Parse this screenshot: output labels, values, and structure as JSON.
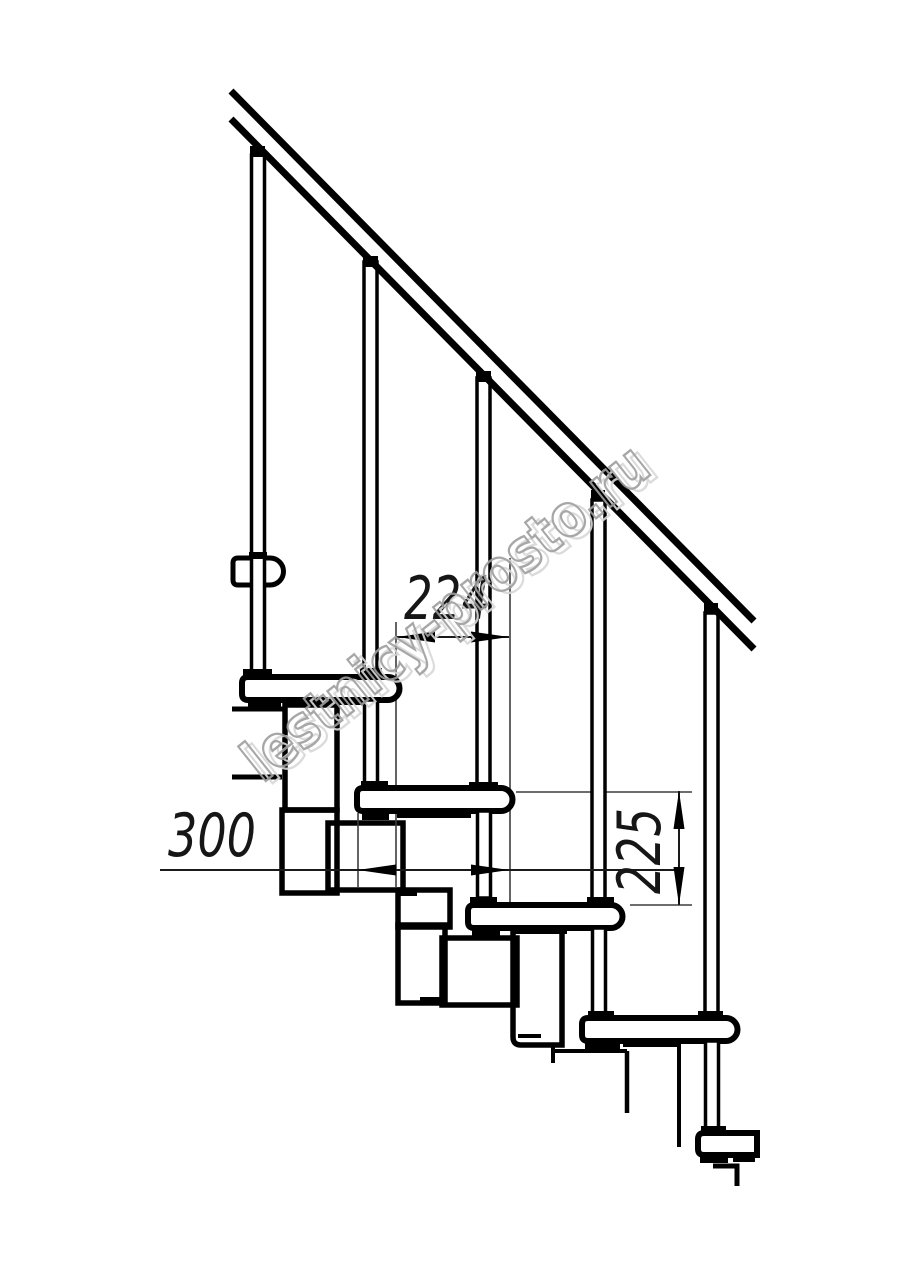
{
  "drawing": {
    "kind": "staircase-side-elevation",
    "dimension_labels": [
      {
        "id": "tread-pitch",
        "value": "224",
        "orientation": "horizontal"
      },
      {
        "id": "tread-depth",
        "value": "300",
        "orientation": "horizontal"
      },
      {
        "id": "step-rise",
        "value": "225",
        "orientation": "vertical"
      }
    ],
    "watermark": {
      "text": "lestnicy-prosto.ru"
    },
    "colors": {
      "line": "#000000",
      "background": "#ffffff",
      "dimension_line": "#3d3d3d",
      "watermark_stroke": "#9e9e9e",
      "watermark_shadow": "#d8d8d8"
    }
  }
}
